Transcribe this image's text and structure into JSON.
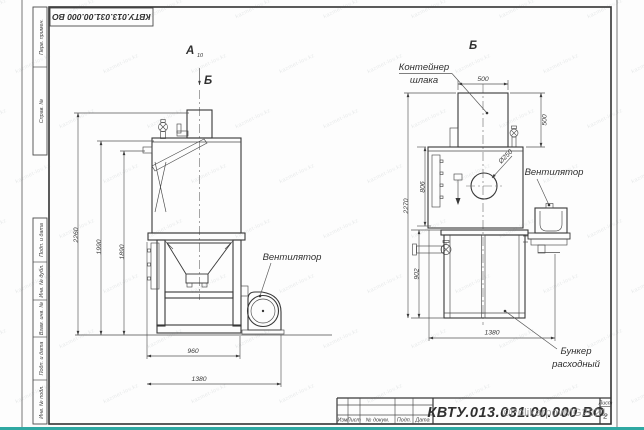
{
  "frame": {
    "top_designation": "КВТУ.013.031.00.000 ВО",
    "side_top": [
      "Перв. примен.",
      "Справ. №"
    ],
    "side_bottom": [
      "Подп. и дата",
      "Инв. № дубл.",
      "Взам. инв. №",
      "Подп. и дата",
      "Инв. № подл."
    ],
    "stamp": {
      "designation": "КВТУ.013.031.00.000 ВО",
      "cols": [
        "Изм",
        "Лист",
        "№ докум.",
        "Подп.",
        "Дата"
      ],
      "sheet_word": "Лист",
      "sheet_number": "2"
    }
  },
  "front_view": {
    "view_letter": "А",
    "view_letter_sub": "10",
    "section_arrow_label": "Б",
    "fan_label": "Вентилятор",
    "dims": {
      "height_total": "2260",
      "height_lid": "1990",
      "height_stub": "1890",
      "width_frame": "960",
      "width_overall": "1380"
    }
  },
  "b_view": {
    "view_label": "Б",
    "container_label": [
      "Контейнер",
      "шлака"
    ],
    "fan_label": "Вентилятор",
    "bunker_label": [
      "Бункер",
      "расходный"
    ],
    "dims": {
      "container_width": "500",
      "container_height": "500",
      "inlet_diameter": "Ø250",
      "body_height": "806",
      "overall_height": "2270",
      "bunker_height": "902",
      "overall_width": "1380"
    }
  },
  "watermark": {
    "tile": "kazmet-lov.kz",
    "copyright": "©PolikarpovMG2021"
  }
}
